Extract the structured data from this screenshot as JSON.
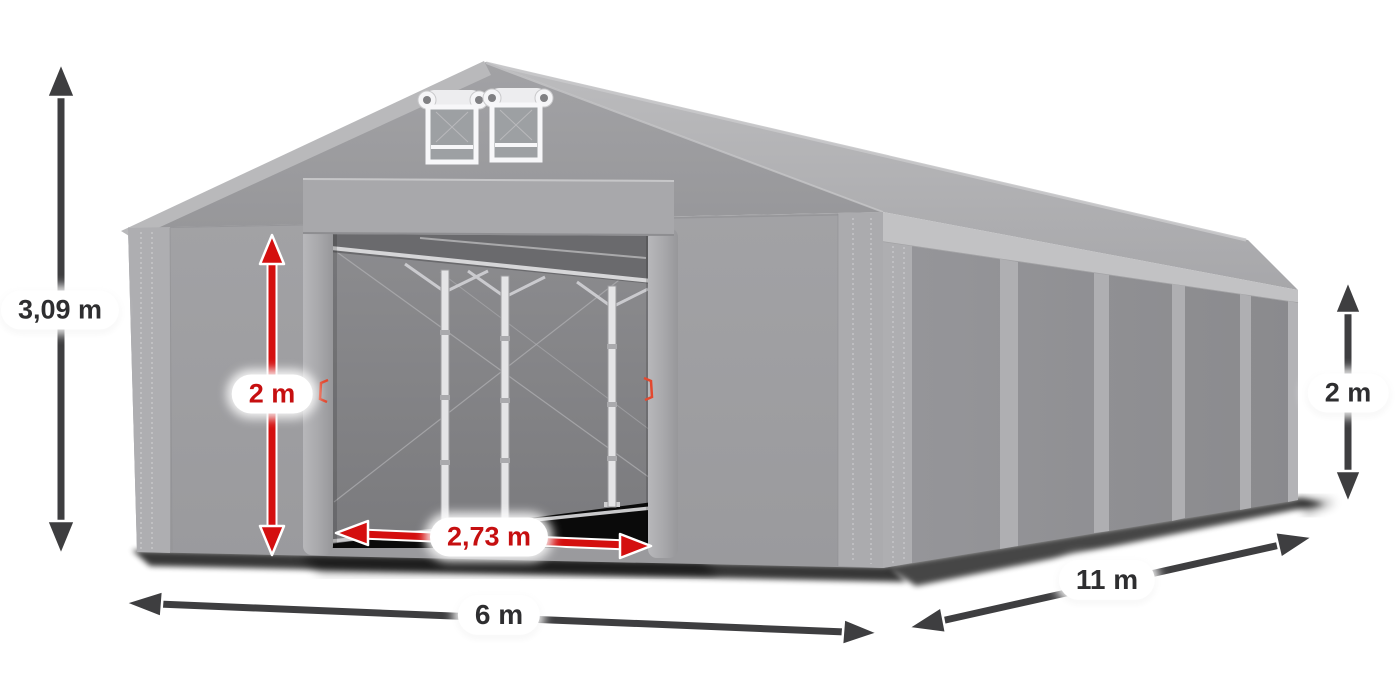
{
  "illustration": {
    "subject": "gray storage tent with entrance open and dimension arrows",
    "tent_color": "#9c9c9f",
    "roof_color": "#b2b2b5",
    "dark_arrow_color": "#3e3e40",
    "red_arrow_color": "#d40f0f",
    "label_text_color": "#2e2e30",
    "label_red_text_color": "#c60f10"
  },
  "dimensions": {
    "total_height": "3,09 m",
    "entrance_height": "2 m",
    "entrance_width": "2,73 m",
    "front_width": "6 m",
    "side_length": "11 m",
    "side_height": "2 m"
  }
}
